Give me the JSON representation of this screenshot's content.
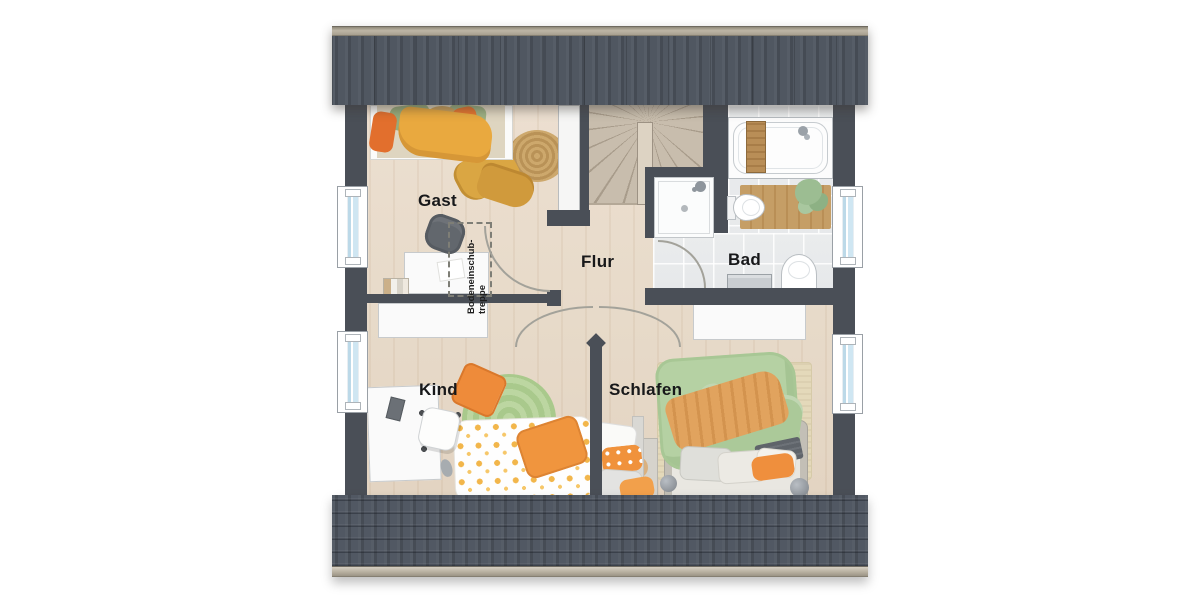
{
  "title": "Dachgeschoss Grundriss",
  "rooms": {
    "gast": {
      "label": "Gast"
    },
    "flur": {
      "label": "Flur"
    },
    "bad": {
      "label": "Bad"
    },
    "kind": {
      "label": "Kind"
    },
    "schlafen": {
      "label": "Schlafen"
    }
  },
  "annotations": {
    "attic": {
      "line1": "Bodeneinschub-",
      "line2": "treppe"
    }
  },
  "colors": {
    "wall": "#4a4f57",
    "roof-base": "#4b525b",
    "wood": "#e7dac9",
    "stair-wood": "#c8bdad",
    "tile": "#e9ebec",
    "glass": "#cfe6f2",
    "textile-green": "#b5d1a3",
    "textile-orange": "#ee8b3a",
    "textile-mustard": "#daa643",
    "rug-green": "#b6d29a",
    "rug-jute": "#c7a065",
    "rug-beige": "#e4d9ba",
    "mat-wood": "#c59e66"
  }
}
